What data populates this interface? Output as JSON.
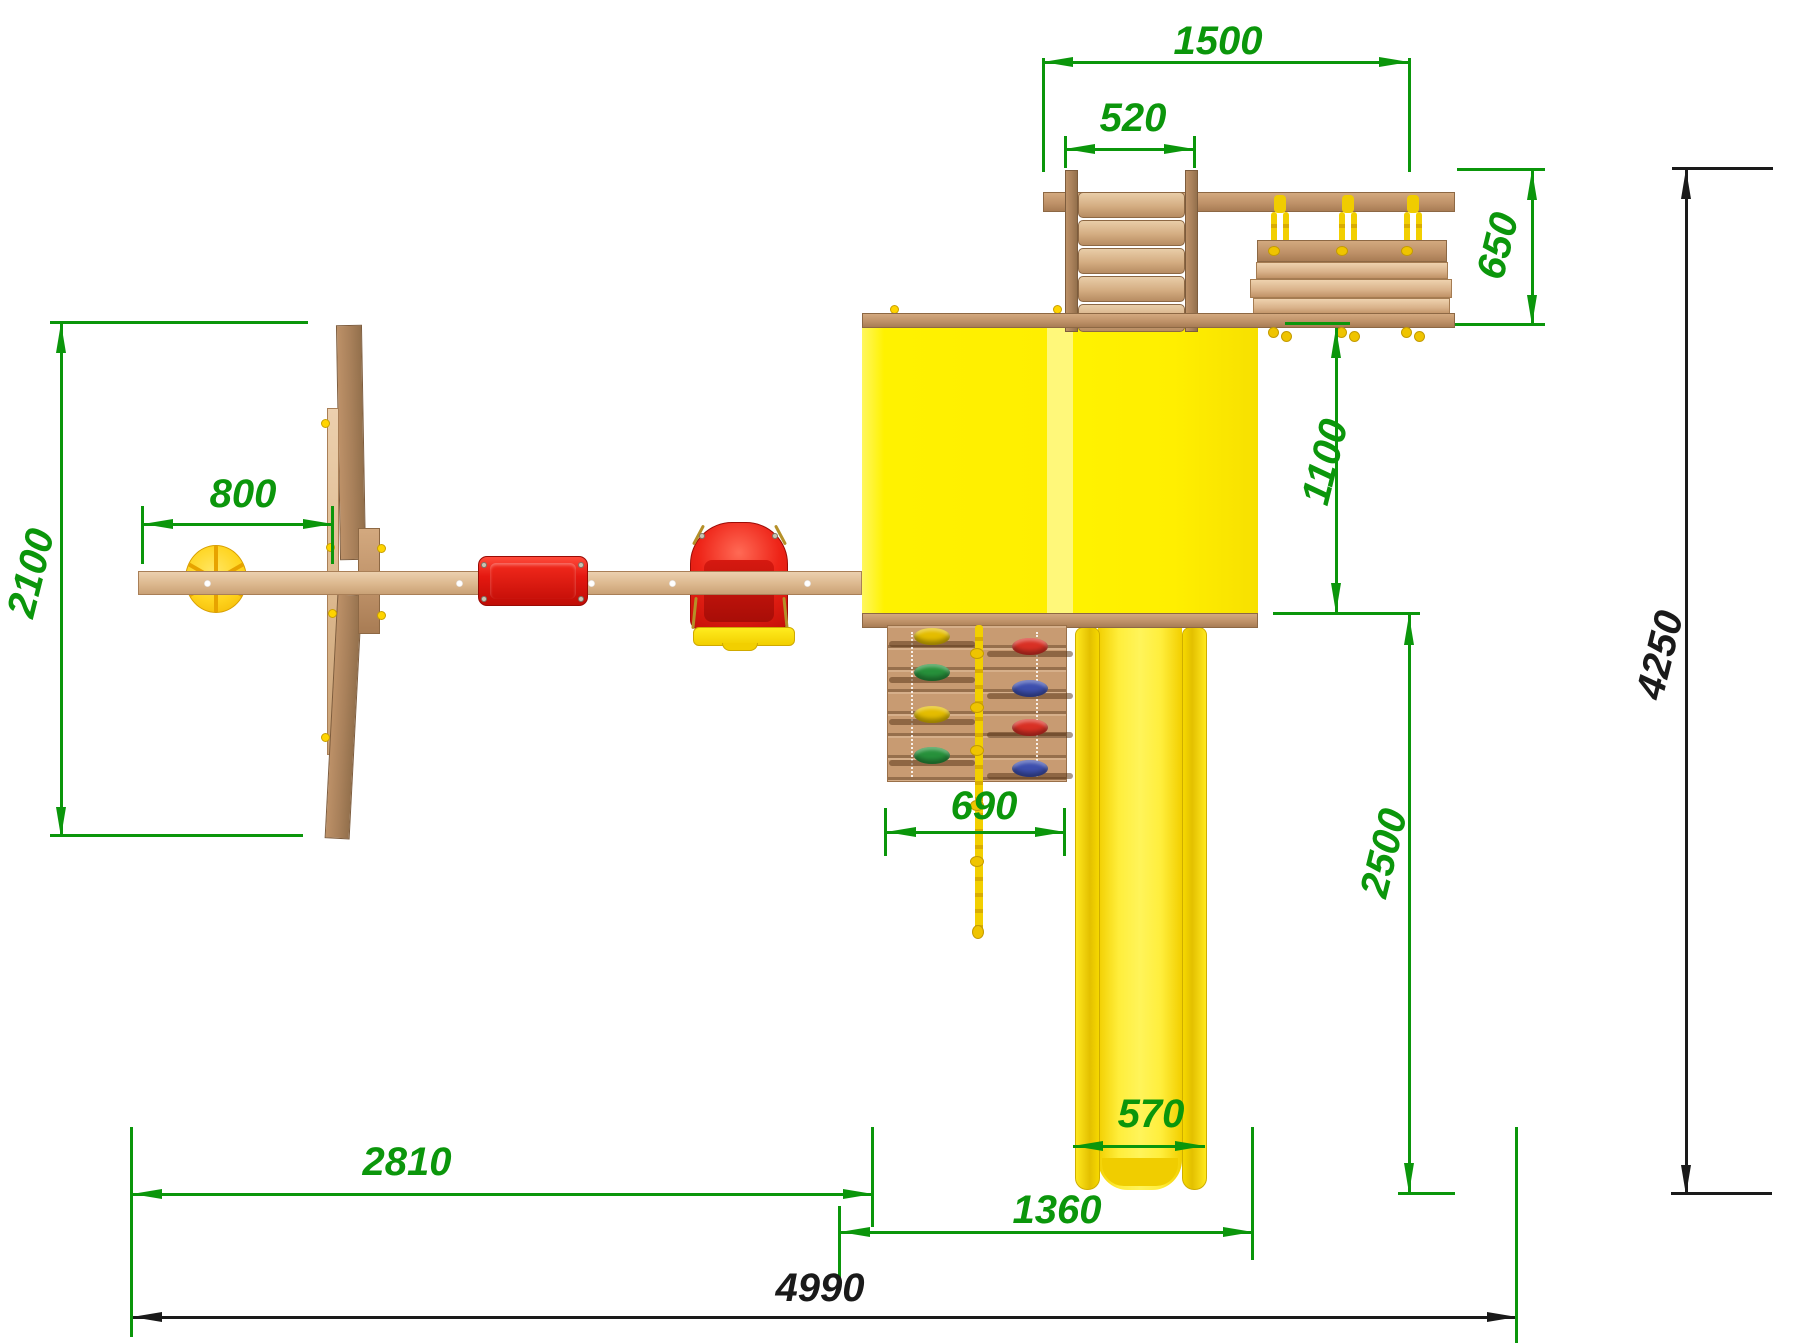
{
  "drawing": {
    "kind": "playground-top-view-plan",
    "dims": {
      "top_width": "1500",
      "ladder_width": "520",
      "bridge_depth": "650",
      "right_offset": "1100",
      "slide_run": "2500",
      "overall_depth": "4250",
      "swing_depth": "2100",
      "disc_offset": "800",
      "climb_wall_width": "690",
      "slide_width": "570",
      "swing_beam_span": "2810",
      "slide_bay_width": "1360",
      "overall_width": "4990"
    },
    "palette": {
      "dimension_green": "#0b960b",
      "dimension_black": "#1a1a1a",
      "roof_yellow": "#ffef00",
      "roof_ridge_yellow": "#fff87a",
      "slide_yellow": "#ffee3c",
      "seat_red": "#e81a12",
      "rope_yellow": "#f0ce00",
      "disc_yellow": "#ffd41e",
      "wood_light": "#e0ba90",
      "wood_mid": "#c79c74",
      "wood_dark": "#a87f5c",
      "hold_yellow": "#e4bd00",
      "hold_green": "#27913b",
      "hold_red": "#d93025",
      "hold_blue": "#3d4fae"
    }
  }
}
